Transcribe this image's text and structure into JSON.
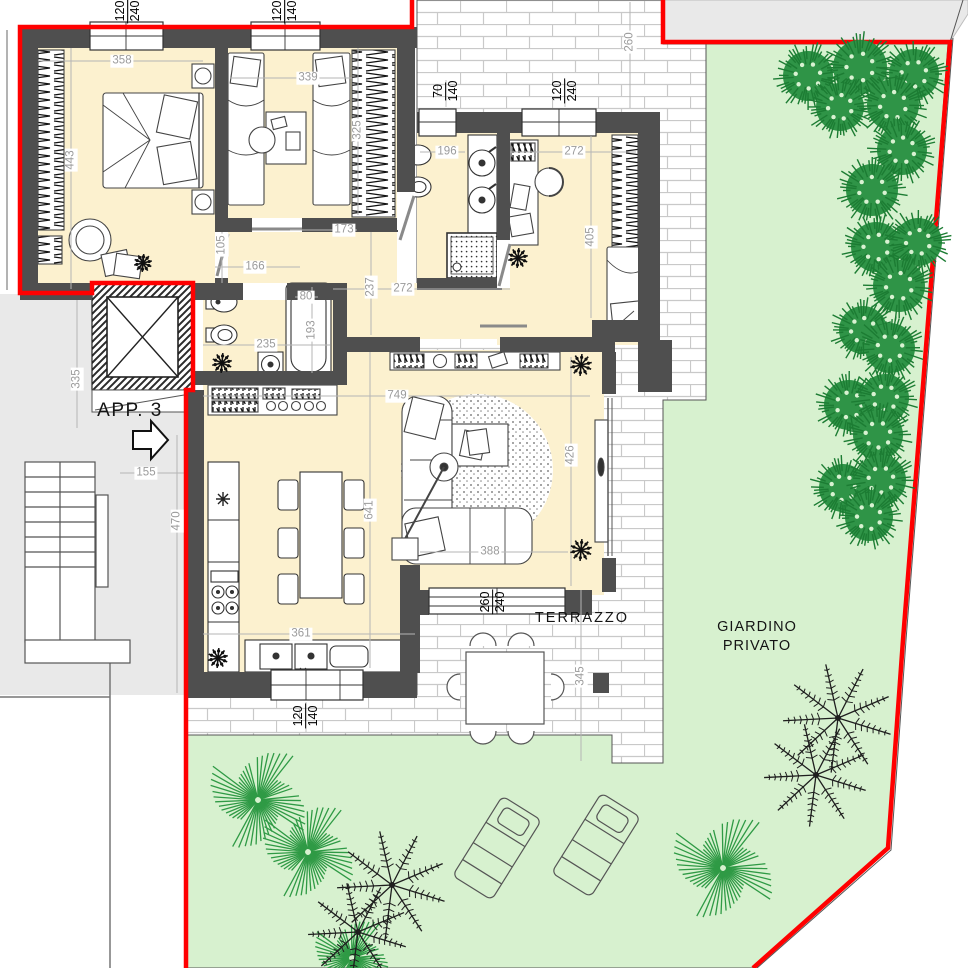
{
  "plan_title": {
    "apartment": "APP. 3"
  },
  "area_labels": {
    "terrace": "TERRAZZO",
    "garden_line1": "GIARDINO",
    "garden_line2": "PRIVATO"
  },
  "colors": {
    "boundary_red": "#ff0000",
    "wall_grey": "#4f4f4f",
    "floor_cream": "#fcf1cf",
    "garden_green": "#d7f1cf",
    "bush_green": "#2f9447",
    "outside_grey": "#e9e9e9",
    "dim_text_grey": "#9b9b9b",
    "label_black": "#141414"
  },
  "dimensions": [
    {
      "t": "358",
      "x": 122,
      "y": 61,
      "r": false
    },
    {
      "t": "443",
      "x": 71,
      "y": 160,
      "r": true
    },
    {
      "t": "339",
      "x": 308,
      "y": 78,
      "r": false
    },
    {
      "t": "325",
      "x": 358,
      "y": 130,
      "r": true
    },
    {
      "t": "105",
      "x": 222,
      "y": 245,
      "r": true
    },
    {
      "t": "166",
      "x": 255,
      "y": 267,
      "r": false
    },
    {
      "t": "173",
      "x": 344,
      "y": 230,
      "r": false
    },
    {
      "t": "196",
      "x": 447,
      "y": 152,
      "r": false
    },
    {
      "t": "272",
      "x": 574,
      "y": 152,
      "r": false
    },
    {
      "t": "405",
      "x": 591,
      "y": 237,
      "r": true
    },
    {
      "t": "237",
      "x": 371,
      "y": 287,
      "r": true
    },
    {
      "t": "272",
      "x": 403,
      "y": 289,
      "r": false
    },
    {
      "t": "235",
      "x": 266,
      "y": 345,
      "r": false
    },
    {
      "t": "80",
      "x": 306,
      "y": 297,
      "r": false
    },
    {
      "t": "193",
      "x": 312,
      "y": 330,
      "r": true
    },
    {
      "t": "749",
      "x": 397,
      "y": 396,
      "r": false
    },
    {
      "t": "641",
      "x": 370,
      "y": 510,
      "r": true
    },
    {
      "t": "426",
      "x": 571,
      "y": 455,
      "r": true
    },
    {
      "t": "388",
      "x": 490,
      "y": 552,
      "r": false
    },
    {
      "t": "361",
      "x": 301,
      "y": 634,
      "r": false
    },
    {
      "t": "470",
      "x": 177,
      "y": 521,
      "r": true
    },
    {
      "t": "155",
      "x": 146,
      "y": 473,
      "r": false
    },
    {
      "t": "335",
      "x": 77,
      "y": 379,
      "r": true
    },
    {
      "t": "345",
      "x": 581,
      "y": 676,
      "r": true
    },
    {
      "t": "260",
      "x": 630,
      "y": 42,
      "r": true
    }
  ],
  "window_dimensions": [
    {
      "a": "120",
      "b": "240",
      "x": 128,
      "y": 11
    },
    {
      "a": "120",
      "b": "140",
      "x": 285,
      "y": 11
    },
    {
      "a": "70",
      "b": "140",
      "x": 446,
      "y": 91
    },
    {
      "a": "120",
      "b": "240",
      "x": 565,
      "y": 91
    },
    {
      "a": "260",
      "b": "240",
      "x": 493,
      "y": 602
    },
    {
      "a": "120",
      "b": "140",
      "x": 306,
      "y": 716
    }
  ]
}
